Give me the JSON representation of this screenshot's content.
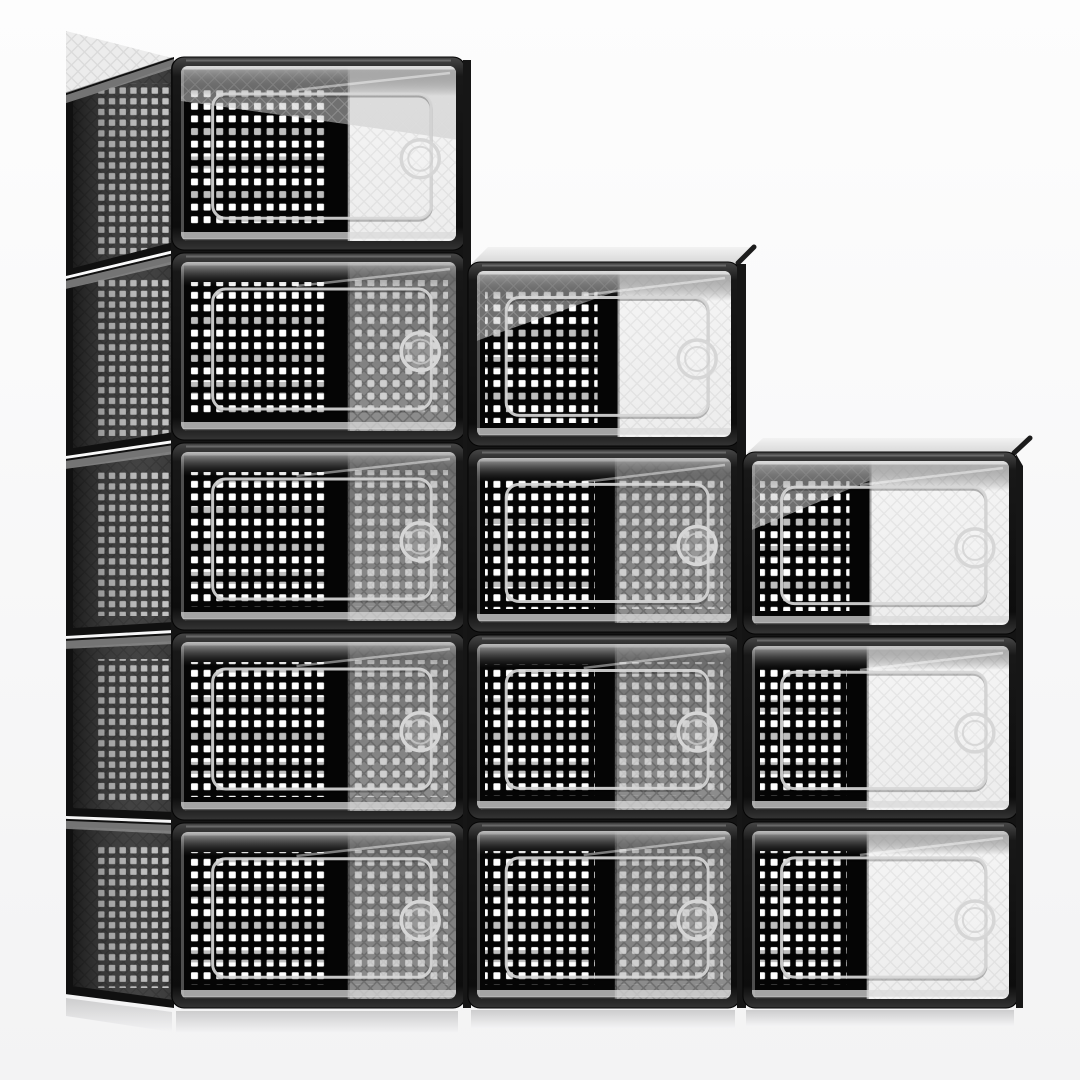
{
  "image": {
    "description": "Product photo: 12-pack stackable clear plastic shoe storage boxes with black frames, perforated mesh side panels and clear drop-front doors with round finger holes, stacked in a descending staircase of three columns (5, 4 and 3 boxes).",
    "box_count": 12,
    "arrangement": "staircase 5-4-3"
  },
  "palette": {
    "background_top": "#fdfdfd",
    "background_bottom": "#f3f3f4",
    "frame_dark": "#101010",
    "frame_light": "#474747",
    "interior": "#050505",
    "mesh_dot": "#ffffff",
    "side_panel": "#2e2e2e",
    "side_dot": "#e3e3e3",
    "frost_dark": "#6f6f6f",
    "frost_light": "#8f8f8f",
    "door_white": "#f1f1f1",
    "door_line": "#d6d6d6",
    "top_band": "#b0b0b0",
    "sliver_light": "#ececec",
    "seam_dark": "#141414"
  },
  "scene": {
    "width": 1080,
    "height": 1080,
    "floor_y": 1008,
    "columns": [
      {
        "id": "left",
        "front_x": 172,
        "front_w": 293,
        "box_tops": [
          57,
          253,
          443,
          633,
          823
        ],
        "box_bottoms": [
          250,
          440,
          630,
          820,
          1008
        ],
        "boundary": [
          0.6,
          0.6,
          0.6,
          0.6,
          0.6
        ],
        "bright": [
          "white",
          "frosted",
          "frosted",
          "frosted",
          "frosted"
        ],
        "wedge_top": "right-thick",
        "has_side_panel": true,
        "right_sliver": [
          463,
          60,
          8,
          948
        ],
        "reflection": [
          176,
          1011,
          282,
          22
        ]
      },
      {
        "id": "middle",
        "front_x": 468,
        "front_w": 272,
        "box_tops": [
          262,
          449,
          635,
          822
        ],
        "box_bottoms": [
          446,
          632,
          819,
          1008
        ],
        "boundary": [
          0.55,
          0.54,
          0.54,
          0.54
        ],
        "bright": [
          "white",
          "frosted",
          "frosted",
          "frosted"
        ],
        "wedge_top": "left-thick",
        "top_sliver": [
          [
            472,
            263
          ],
          [
            738,
            263
          ],
          [
            754,
            247
          ],
          [
            488,
            247
          ]
        ],
        "right_sliver": [
          737,
          264,
          9,
          744
        ],
        "reflection": [
          471,
          1010,
          264,
          18
        ]
      },
      {
        "id": "right",
        "front_x": 743,
        "front_w": 275,
        "box_tops": [
          452,
          637,
          822
        ],
        "box_bottoms": [
          634,
          819,
          1008
        ],
        "boundary": [
          0.46,
          0.45,
          0.45
        ],
        "bright": [
          "white",
          "white",
          "white"
        ],
        "wedge_top": "left-thick",
        "top_sliver": [
          [
            747,
            453
          ],
          [
            1014,
            453
          ],
          [
            1030,
            438
          ],
          [
            763,
            438
          ]
        ],
        "right_edge_sliver": [
          [
            1016,
            454
          ],
          [
            1023,
            466
          ],
          [
            1023,
            1008
          ],
          [
            1016,
            1008
          ]
        ],
        "reflection": [
          746,
          1010,
          268,
          16
        ]
      }
    ],
    "side_panel": {
      "back_x": 66,
      "front_x": 172,
      "top_front_y": 60,
      "top_back_y": 96,
      "bottom_front_y": 1010,
      "bottom_back_y": 996,
      "glancing_triangle": [
        [
          172,
          58
        ],
        [
          66,
          93
        ],
        [
          66,
          31
        ]
      ],
      "dots_inset_back": 32,
      "reflection_wedge": [
        [
          66,
          998
        ],
        [
          172,
          1012
        ],
        [
          172,
          1032
        ],
        [
          66,
          1016
        ]
      ]
    },
    "door": {
      "left": 0.115,
      "width": 0.795,
      "top": 0.16,
      "height": 0.71,
      "rx": 13,
      "circle_r": 19,
      "circle_inner_r": 12,
      "circle_offset": 11,
      "circle_cy": 0.53
    },
    "frame_inset": 9,
    "mesh": {
      "tile": 12.6,
      "dot": 7.0,
      "side_tile": 10.7,
      "side_dot": 6.4
    }
  }
}
